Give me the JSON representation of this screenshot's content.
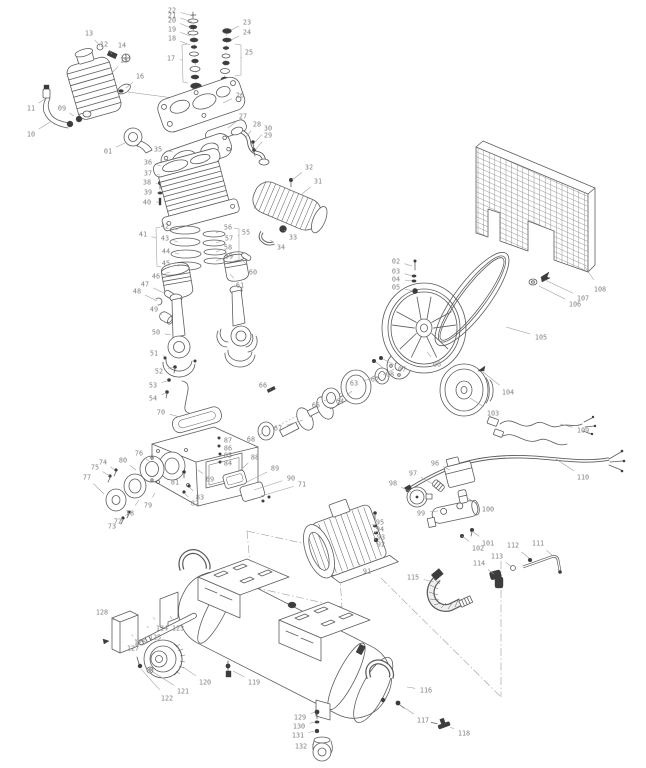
{
  "meta": {
    "figure_type": "exploded-parts-diagram",
    "subject": "belt-driven air compressor with horizontal tank",
    "callout_range": "01-132"
  },
  "style": {
    "ink": "#5c5c5c",
    "label_color": "#828282",
    "leader_color": "#9b9b9b",
    "hardware_fill": "#3d3d3d",
    "background": "#ffffff"
  },
  "callouts": [
    {
      "n": "01",
      "l": [
        108,
        151
      ],
      "t": [
        127,
        142
      ]
    },
    {
      "n": "02",
      "l": [
        396,
        261
      ],
      "t": [
        412,
        266
      ]
    },
    {
      "n": "03",
      "l": [
        396,
        271
      ],
      "t": [
        412,
        276
      ]
    },
    {
      "n": "04",
      "l": [
        396,
        279
      ],
      "t": [
        412,
        281
      ]
    },
    {
      "n": "05",
      "l": [
        396,
        287
      ],
      "t": [
        413,
        291
      ]
    },
    {
      "n": "06",
      "l": [
        437,
        364
      ],
      "t": [
        427,
        352
      ]
    },
    {
      "n": "07",
      "l": [
        402,
        369
      ],
      "t": [
        383,
        359
      ]
    },
    {
      "n": "08",
      "l": [
        390,
        374
      ],
      "t": [
        376,
        362
      ]
    },
    {
      "n": "09",
      "l": [
        62,
        108
      ],
      "t": [
        74,
        116
      ]
    },
    {
      "n": "10",
      "l": [
        31,
        134
      ],
      "t": [
        50,
        122
      ]
    },
    {
      "n": "11",
      "l": [
        31,
        108
      ],
      "t": [
        45,
        99
      ]
    },
    {
      "n": "12",
      "l": [
        104,
        44
      ],
      "t": [
        112,
        54
      ]
    },
    {
      "n": "13",
      "l": [
        89,
        33
      ],
      "t": [
        100,
        46
      ]
    },
    {
      "n": "14",
      "l": [
        122,
        45
      ],
      "t": [
        126,
        57
      ]
    },
    {
      "n": "15",
      "l": [
        124,
        60
      ],
      "t": [
        110,
        75
      ]
    },
    {
      "n": "16",
      "l": [
        140,
        76
      ],
      "t": [
        126,
        88
      ]
    },
    {
      "n": "17",
      "l": [
        171,
        58
      ],
      "t": [
        182,
        60
      ]
    },
    {
      "n": "18",
      "l": [
        172,
        38
      ],
      "t": [
        190,
        45
      ]
    },
    {
      "n": "19",
      "l": [
        172,
        29
      ],
      "t": [
        190,
        36
      ]
    },
    {
      "n": "20",
      "l": [
        172,
        20
      ],
      "t": [
        191,
        28
      ]
    },
    {
      "n": "21",
      "l": [
        172,
        15
      ],
      "t": [
        192,
        22
      ]
    },
    {
      "n": "22",
      "l": [
        172,
        10
      ],
      "t": [
        193,
        16
      ]
    },
    {
      "n": "23",
      "l": [
        247,
        22
      ],
      "t": [
        231,
        30
      ]
    },
    {
      "n": "24",
      "l": [
        247,
        32
      ],
      "t": [
        231,
        40
      ]
    },
    {
      "n": "25",
      "l": [
        249,
        52
      ],
      "t": [
        241,
        58
      ]
    },
    {
      "n": "26",
      "l": [
        240,
        95
      ],
      "t": [
        223,
        103
      ]
    },
    {
      "n": "27",
      "l": [
        243,
        116
      ],
      "t": [
        228,
        128
      ]
    },
    {
      "n": "28",
      "l": [
        257,
        124
      ],
      "t": [
        245,
        138
      ]
    },
    {
      "n": "29",
      "l": [
        268,
        135
      ],
      "t": [
        255,
        150
      ]
    },
    {
      "n": "30",
      "l": [
        268,
        128
      ],
      "t": [
        254,
        143
      ]
    },
    {
      "n": "31",
      "l": [
        318,
        181
      ],
      "t": [
        302,
        194
      ]
    },
    {
      "n": "32",
      "l": [
        309,
        167
      ],
      "t": [
        292,
        180
      ]
    },
    {
      "n": "33",
      "l": [
        293,
        237
      ],
      "t": [
        284,
        230
      ]
    },
    {
      "n": "34",
      "l": [
        281,
        247
      ],
      "t": [
        270,
        240
      ]
    },
    {
      "n": "35",
      "l": [
        158,
        149
      ],
      "t": [
        173,
        152
      ]
    },
    {
      "n": "36",
      "l": [
        148,
        162
      ],
      "t": [
        161,
        166
      ]
    },
    {
      "n": "37",
      "l": [
        148,
        173
      ],
      "t": [
        160,
        175
      ]
    },
    {
      "n": "38",
      "l": [
        147,
        182
      ],
      "t": [
        159,
        184
      ]
    },
    {
      "n": "39",
      "l": [
        148,
        192
      ],
      "t": [
        159,
        193
      ]
    },
    {
      "n": "40",
      "l": [
        147,
        202
      ],
      "t": [
        159,
        202
      ]
    },
    {
      "n": "41",
      "l": [
        143,
        234
      ],
      "t": [
        156,
        238
      ]
    },
    {
      "n": "42",
      "l": [
        165,
        226
      ],
      "t": [
        178,
        230
      ]
    },
    {
      "n": "43",
      "l": [
        165,
        238
      ],
      "t": [
        178,
        242
      ]
    },
    {
      "n": "44",
      "l": [
        166,
        251
      ],
      "t": [
        179,
        254
      ]
    },
    {
      "n": "45",
      "l": [
        166,
        263
      ],
      "t": [
        179,
        266
      ]
    },
    {
      "n": "46",
      "l": [
        156,
        276
      ],
      "t": [
        170,
        272
      ]
    },
    {
      "n": "47",
      "l": [
        145,
        284
      ],
      "t": [
        164,
        293
      ]
    },
    {
      "n": "48",
      "l": [
        137,
        291
      ],
      "t": [
        157,
        301
      ]
    },
    {
      "n": "49",
      "l": [
        154,
        309
      ],
      "t": [
        162,
        315
      ]
    },
    {
      "n": "50",
      "l": [
        156,
        332
      ],
      "t": [
        171,
        335
      ]
    },
    {
      "n": "51",
      "l": [
        154,
        353
      ],
      "t": [
        167,
        357
      ]
    },
    {
      "n": "52",
      "l": [
        159,
        371
      ],
      "t": [
        173,
        367
      ]
    },
    {
      "n": "53",
      "l": [
        153,
        385
      ],
      "t": [
        167,
        381
      ]
    },
    {
      "n": "54",
      "l": [
        153,
        398
      ],
      "t": [
        166,
        393
      ]
    },
    {
      "n": "55",
      "l": [
        246,
        232
      ],
      "t": [
        239,
        235
      ]
    },
    {
      "n": "56",
      "l": [
        228,
        227
      ],
      "t": [
        216,
        233
      ]
    },
    {
      "n": "57",
      "l": [
        229,
        238
      ],
      "t": [
        216,
        243
      ]
    },
    {
      "n": "58",
      "l": [
        228,
        247
      ],
      "t": [
        216,
        252
      ]
    },
    {
      "n": "59",
      "l": [
        229,
        256
      ],
      "t": [
        216,
        261
      ]
    },
    {
      "n": "60",
      "l": [
        253,
        272
      ],
      "t": [
        243,
        261
      ]
    },
    {
      "n": "61",
      "l": [
        240,
        285
      ],
      "t": [
        230,
        274
      ]
    },
    {
      "n": "62",
      "l": [
        375,
        379
      ],
      "t": [
        394,
        369
      ]
    },
    {
      "n": "63",
      "l": [
        354,
        383
      ],
      "t": [
        379,
        377
      ]
    },
    {
      "n": "64",
      "l": [
        340,
        401
      ],
      "t": [
        352,
        391
      ]
    },
    {
      "n": "65",
      "l": [
        316,
        405
      ],
      "t": [
        328,
        399
      ]
    },
    {
      "n": "66",
      "l": [
        263,
        385
      ],
      "t": [
        270,
        389
      ]
    },
    {
      "n": "67",
      "l": [
        278,
        428
      ],
      "t": [
        303,
        420
      ]
    },
    {
      "n": "68",
      "l": [
        251,
        439
      ],
      "t": [
        263,
        433
      ]
    },
    {
      "n": "69",
      "l": [
        210,
        479
      ],
      "t": [
        198,
        470
      ]
    },
    {
      "n": "70",
      "l": [
        161,
        412
      ],
      "t": [
        180,
        417
      ]
    },
    {
      "n": "71",
      "l": [
        302,
        484
      ],
      "t": [
        261,
        496
      ]
    },
    {
      "n": "72",
      "l": [
        118,
        521
      ],
      "t": [
        129,
        513
      ]
    },
    {
      "n": "73",
      "l": [
        112,
        526
      ],
      "t": [
        123,
        519
      ]
    },
    {
      "n": "74",
      "l": [
        103,
        462
      ],
      "t": [
        115,
        470
      ]
    },
    {
      "n": "75",
      "l": [
        95,
        467
      ],
      "t": [
        110,
        476
      ]
    },
    {
      "n": "76",
      "l": [
        139,
        453
      ],
      "t": [
        150,
        462
      ]
    },
    {
      "n": "77",
      "l": [
        87,
        477
      ],
      "t": [
        104,
        494
      ]
    },
    {
      "n": "78",
      "l": [
        130,
        513
      ],
      "t": [
        139,
        500
      ]
    },
    {
      "n": "79",
      "l": [
        148,
        505
      ],
      "t": [
        155,
        493
      ]
    },
    {
      "n": "80",
      "l": [
        123,
        460
      ],
      "t": [
        136,
        470
      ]
    },
    {
      "n": "81",
      "l": [
        175,
        482
      ],
      "t": [
        184,
        473
      ]
    },
    {
      "n": "82",
      "l": [
        195,
        503
      ],
      "t": [
        184,
        493
      ]
    },
    {
      "n": "83",
      "l": [
        200,
        497
      ],
      "t": [
        189,
        487
      ]
    },
    {
      "n": "84",
      "l": [
        228,
        463
      ],
      "t": [
        220,
        462
      ]
    },
    {
      "n": "85",
      "l": [
        228,
        455
      ],
      "t": [
        219,
        454
      ]
    },
    {
      "n": "86",
      "l": [
        228,
        448
      ],
      "t": [
        219,
        446
      ]
    },
    {
      "n": "87",
      "l": [
        228,
        440
      ],
      "t": [
        218,
        439
      ]
    },
    {
      "n": "88",
      "l": [
        255,
        457
      ],
      "t": [
        238,
        472
      ]
    },
    {
      "n": "89",
      "l": [
        275,
        468
      ],
      "t": [
        247,
        482
      ]
    },
    {
      "n": "90",
      "l": [
        291,
        478
      ],
      "t": [
        254,
        490
      ]
    },
    {
      "n": "91",
      "l": [
        367,
        571
      ],
      "t": [
        357,
        562
      ]
    },
    {
      "n": "92",
      "l": [
        381,
        544
      ],
      "t": [
        376,
        540
      ]
    },
    {
      "n": "93",
      "l": [
        381,
        537
      ],
      "t": [
        376,
        533
      ]
    },
    {
      "n": "94",
      "l": [
        380,
        529
      ],
      "t": [
        375,
        526
      ]
    },
    {
      "n": "95",
      "l": [
        380,
        522
      ],
      "t": [
        375,
        517
      ]
    },
    {
      "n": "96",
      "l": [
        435,
        463
      ],
      "t": [
        450,
        470
      ]
    },
    {
      "n": "97",
      "l": [
        413,
        473
      ],
      "t": [
        433,
        484
      ]
    },
    {
      "n": "98",
      "l": [
        393,
        483
      ],
      "t": [
        411,
        492
      ]
    },
    {
      "n": "99",
      "l": [
        421,
        513
      ],
      "t": [
        438,
        511
      ]
    },
    {
      "n": "100",
      "l": [
        488,
        509
      ],
      "t": [
        467,
        498
      ]
    },
    {
      "n": "101",
      "l": [
        488,
        543
      ],
      "t": [
        472,
        531
      ]
    },
    {
      "n": "102",
      "l": [
        478,
        548
      ],
      "t": [
        462,
        536
      ]
    },
    {
      "n": "103",
      "l": [
        493,
        413
      ],
      "t": [
        470,
        398
      ]
    },
    {
      "n": "104",
      "l": [
        508,
        392
      ],
      "t": [
        483,
        372
      ]
    },
    {
      "n": "105",
      "l": [
        541,
        337
      ],
      "t": [
        506,
        327
      ]
    },
    {
      "n": "106",
      "l": [
        575,
        304
      ],
      "t": [
        539,
        286
      ]
    },
    {
      "n": "107",
      "l": [
        583,
        298
      ],
      "t": [
        545,
        280
      ]
    },
    {
      "n": "108",
      "l": [
        600,
        289
      ],
      "t": [
        585,
        267
      ]
    },
    {
      "n": "109",
      "l": [
        583,
        430
      ],
      "t": [
        560,
        424
      ]
    },
    {
      "n": "110",
      "l": [
        583,
        477
      ],
      "t": [
        556,
        459
      ]
    },
    {
      "n": "111",
      "l": [
        538,
        543
      ],
      "t": [
        553,
        556
      ]
    },
    {
      "n": "112",
      "l": [
        513,
        545
      ],
      "t": [
        529,
        558
      ]
    },
    {
      "n": "113",
      "l": [
        497,
        556
      ],
      "t": [
        512,
        567
      ]
    },
    {
      "n": "114",
      "l": [
        479,
        563
      ],
      "t": [
        494,
        574
      ]
    },
    {
      "n": "115",
      "l": [
        413,
        577
      ],
      "t": [
        434,
        582
      ]
    },
    {
      "n": "116",
      "l": [
        426,
        690
      ],
      "t": [
        407,
        687
      ]
    },
    {
      "n": "117",
      "l": [
        423,
        720
      ],
      "t": [
        400,
        705
      ]
    },
    {
      "n": "118",
      "l": [
        464,
        733
      ],
      "t": [
        450,
        727
      ]
    },
    {
      "n": "119",
      "l": [
        254,
        682
      ],
      "t": [
        233,
        671
      ]
    },
    {
      "n": "120",
      "l": [
        205,
        682
      ],
      "t": [
        183,
        667
      ]
    },
    {
      "n": "121",
      "l": [
        183,
        691
      ],
      "t": [
        153,
        672
      ]
    },
    {
      "n": "122",
      "l": [
        167,
        698
      ],
      "t": [
        141,
        669
      ]
    },
    {
      "n": "123",
      "l": [
        178,
        628
      ],
      "t": [
        170,
        616
      ]
    },
    {
      "n": "124",
      "l": [
        162,
        628
      ],
      "t": [
        153,
        617
      ]
    },
    {
      "n": "125",
      "l": [
        155,
        637
      ],
      "t": [
        147,
        626
      ]
    },
    {
      "n": "126",
      "l": [
        140,
        642
      ],
      "t": [
        133,
        636
      ]
    },
    {
      "n": "127",
      "l": [
        133,
        648
      ],
      "t": [
        124,
        642
      ]
    },
    {
      "n": "128",
      "l": [
        102,
        612
      ],
      "t": [
        114,
        620
      ]
    },
    {
      "n": "129",
      "l": [
        300,
        717
      ],
      "t": [
        315,
        712
      ]
    },
    {
      "n": "130",
      "l": [
        299,
        726
      ],
      "t": [
        315,
        722
      ]
    },
    {
      "n": "131",
      "l": [
        298,
        735
      ],
      "t": [
        315,
        731
      ]
    },
    {
      "n": "132",
      "l": [
        301,
        746
      ],
      "t": [
        314,
        744
      ]
    }
  ],
  "brackets": [
    {
      "for": "17",
      "d": "M187,44 L182,45 L183,82 L188,83"
    },
    {
      "for": "25",
      "d": "M235,44 L241,45 L241,75 L235,76"
    },
    {
      "for": "41",
      "d": "M160,227 L156,228 L157,266 L161,267"
    },
    {
      "for": "55",
      "d": "M234,228 L239,229 L239,260 L234,261"
    }
  ],
  "dash_lines": [
    {
      "k": "dot",
      "d": "M193,14 L197,102"
    },
    {
      "k": "dot",
      "d": "M227,30 L223,100"
    },
    {
      "k": "dot",
      "d": "M262,434 L409,358"
    },
    {
      "k": "solid",
      "d": "M128,92 L196,101"
    },
    {
      "k": "dd",
      "d": "M247,531 L338,551 L342,607 L252,587 Z"
    },
    {
      "k": "dd",
      "d": "M501,561 L501,697"
    },
    {
      "k": "dd",
      "d": "M381,578 L501,697"
    }
  ]
}
